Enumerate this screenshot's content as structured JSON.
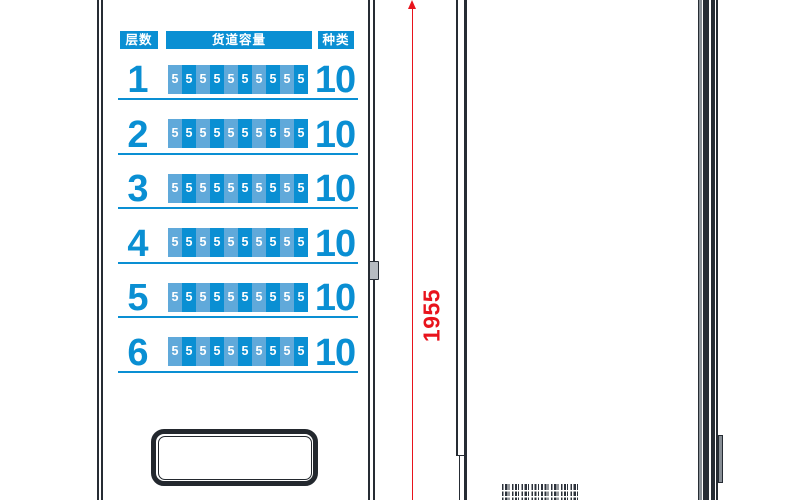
{
  "capacity_table": {
    "headers": [
      "层数",
      "货道容量",
      "种类"
    ],
    "rows": [
      {
        "layer": "1",
        "cells": [
          "5",
          "5",
          "5",
          "5",
          "5",
          "5",
          "5",
          "5",
          "5",
          "5"
        ],
        "types": "10"
      },
      {
        "layer": "2",
        "cells": [
          "5",
          "5",
          "5",
          "5",
          "5",
          "5",
          "5",
          "5",
          "5",
          "5"
        ],
        "types": "10"
      },
      {
        "layer": "3",
        "cells": [
          "5",
          "5",
          "5",
          "5",
          "5",
          "5",
          "5",
          "5",
          "5",
          "5"
        ],
        "types": "10"
      },
      {
        "layer": "4",
        "cells": [
          "5",
          "5",
          "5",
          "5",
          "5",
          "5",
          "5",
          "5",
          "5",
          "5"
        ],
        "types": "10"
      },
      {
        "layer": "5",
        "cells": [
          "5",
          "5",
          "5",
          "5",
          "5",
          "5",
          "5",
          "5",
          "5",
          "5"
        ],
        "types": "10"
      },
      {
        "layer": "6",
        "cells": [
          "5",
          "5",
          "5",
          "5",
          "5",
          "5",
          "5",
          "5",
          "5",
          "5"
        ],
        "types": "10"
      }
    ]
  },
  "dimension": {
    "height_label": "1955"
  },
  "colors": {
    "primary_blue": "#0a8fd3",
    "light_blue": "#60a9da",
    "dimension_red": "#e8131c",
    "frame_dark": "#262c34",
    "metal_gray": "#878e95"
  }
}
